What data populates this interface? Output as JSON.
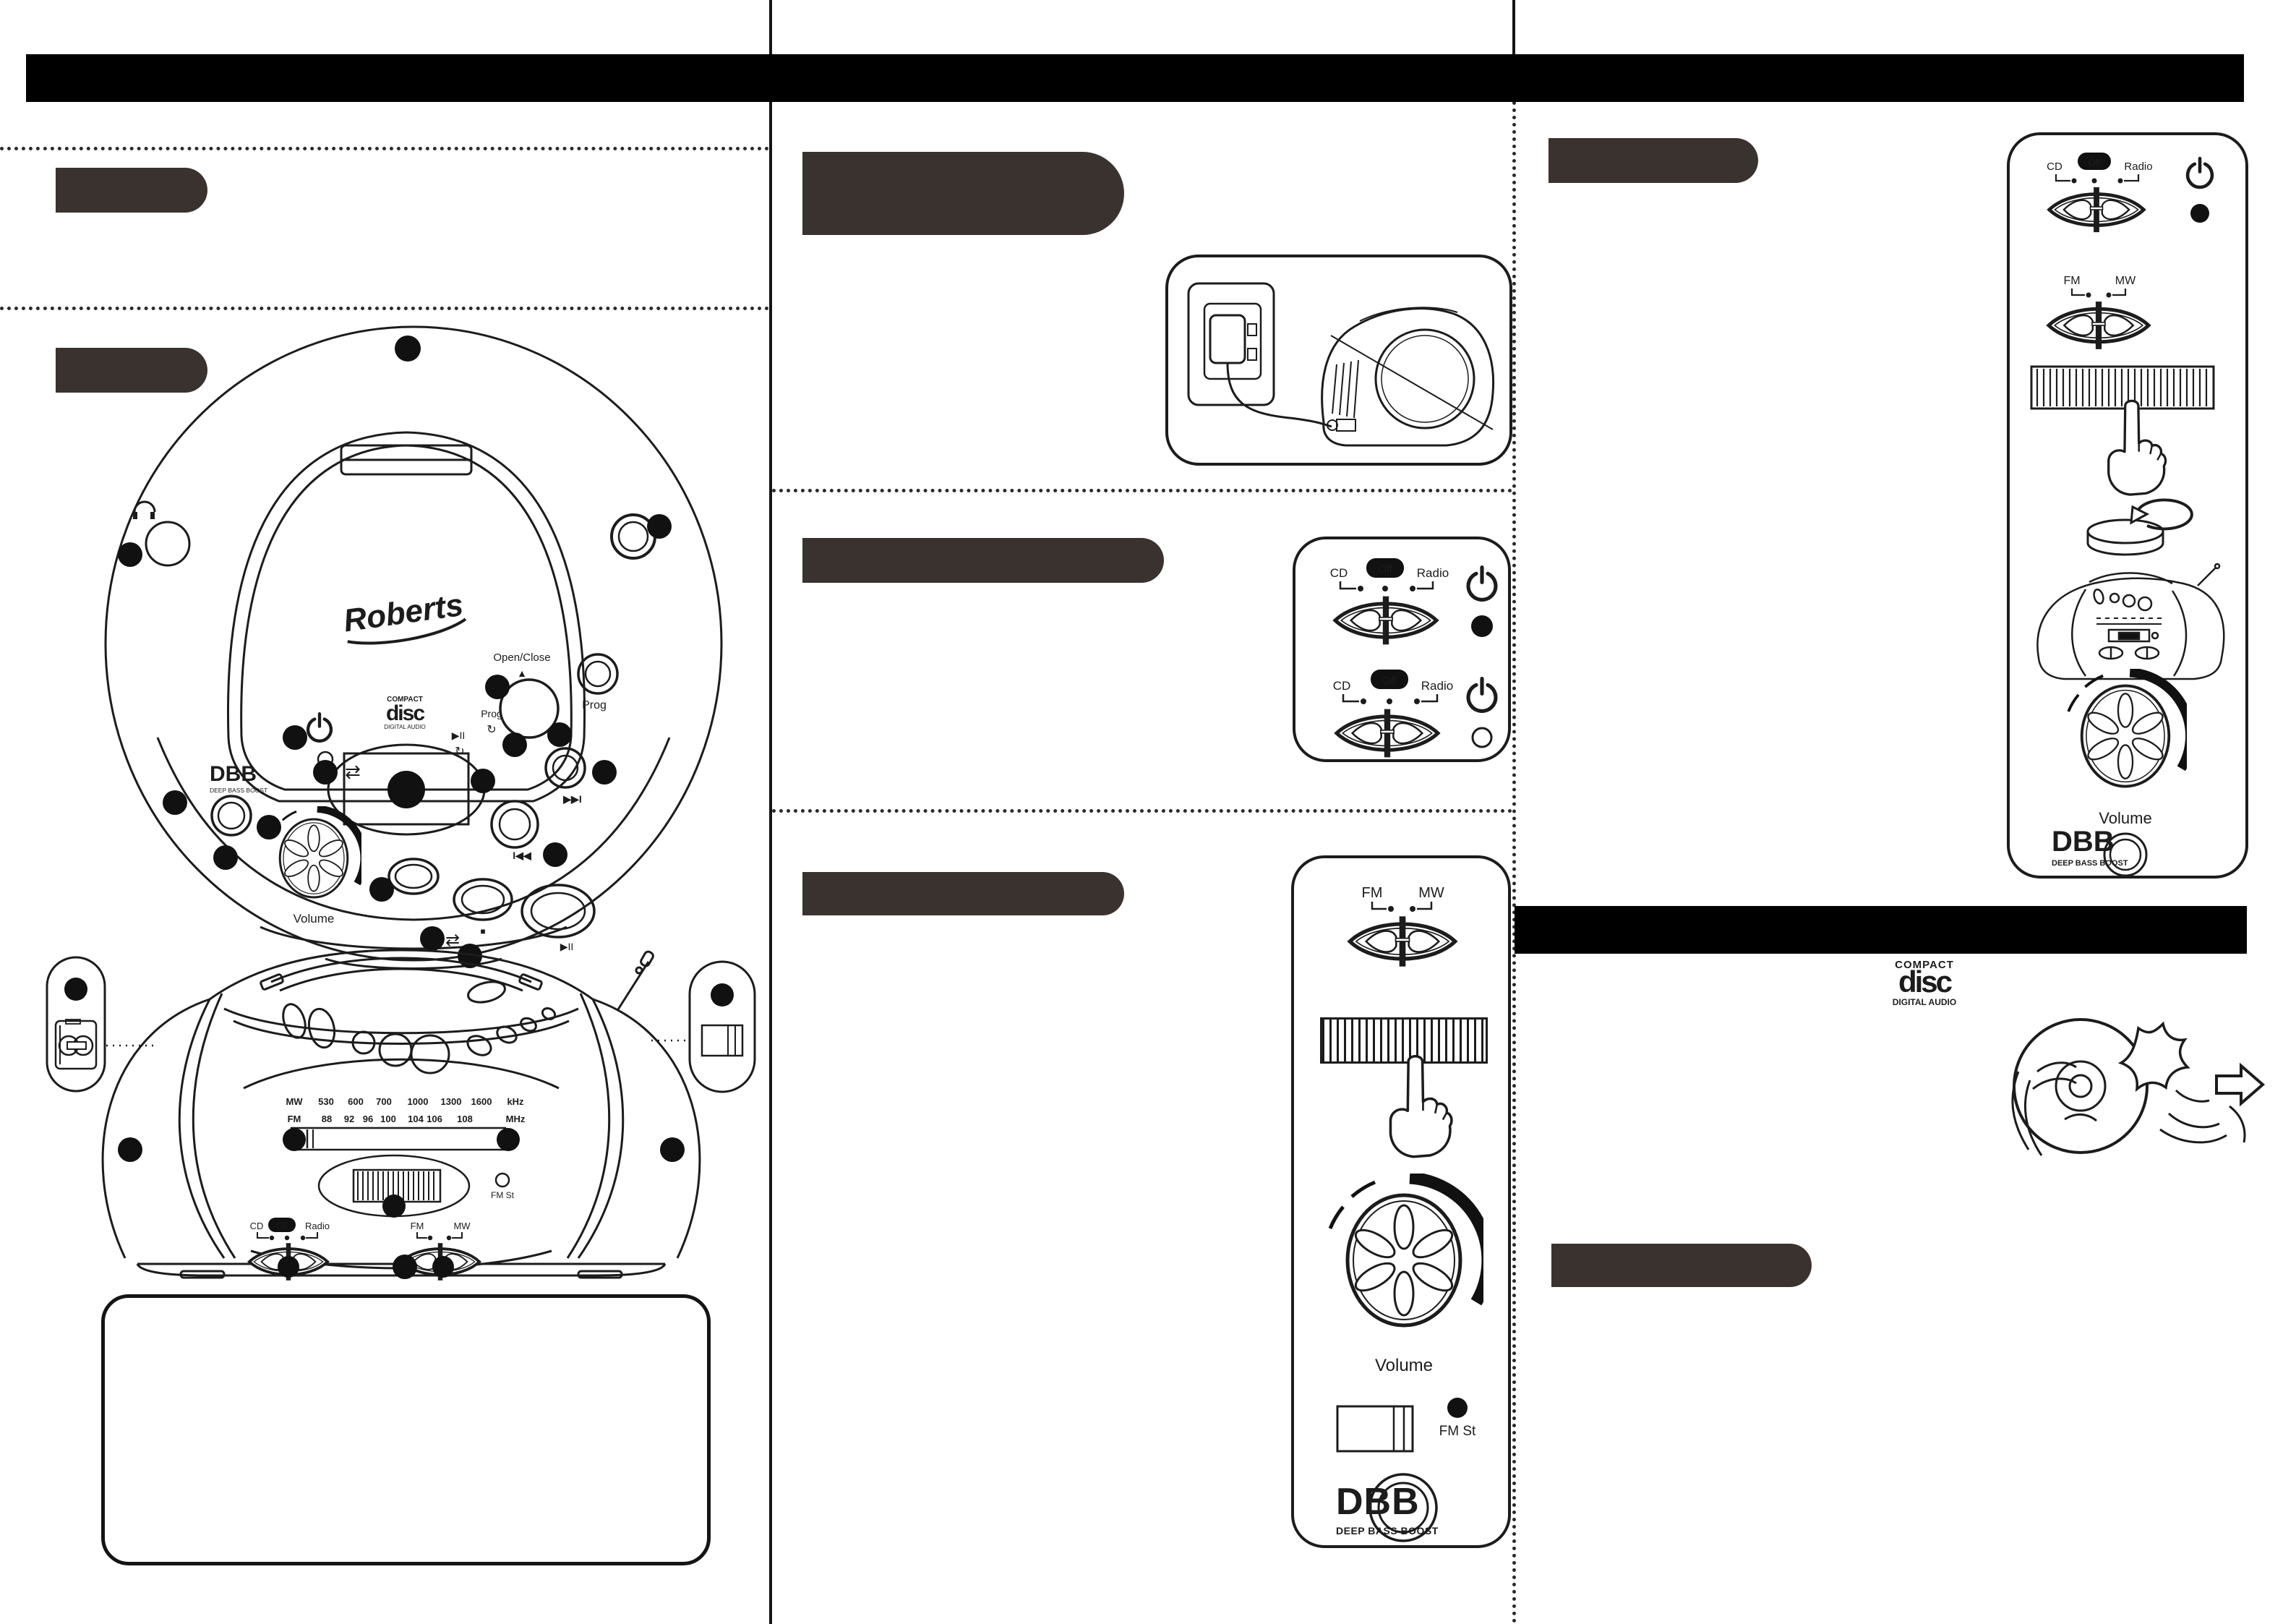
{
  "page": {
    "bg": "#ffffff",
    "ink": "#1c1c1c",
    "bar_color": "#000000",
    "tab_color": "#3a322e"
  },
  "labels": {
    "brand": "Roberts",
    "open_close": "Open/Close",
    "eject": "▲",
    "volume": "Volume",
    "prog": "Prog",
    "dbb": "DBB",
    "dbb_sub": "DEEP BASS BOOST",
    "fm_st": "FM St",
    "cd": "CD",
    "off": "Off",
    "radio": "Radio",
    "fm": "FM",
    "mw": "MW",
    "play_pause": "▶II",
    "next": "▶▶I",
    "prev": "I◀◀",
    "repeat": "⇄",
    "loop": "↻",
    "stop": "■"
  },
  "cd_logo": {
    "compact": "COMPACT",
    "disc": "disc",
    "digital": "DIGITAL AUDIO"
  },
  "dial": {
    "mw_band": "MW",
    "mw_ticks": [
      "530",
      "600",
      "700",
      "1000",
      "1300",
      "1600"
    ],
    "mw_unit": "kHz",
    "fm_band": "FM",
    "fm_ticks": [
      "88",
      "92",
      "96",
      "100",
      "104",
      "106",
      "108"
    ],
    "fm_unit": "MHz"
  }
}
